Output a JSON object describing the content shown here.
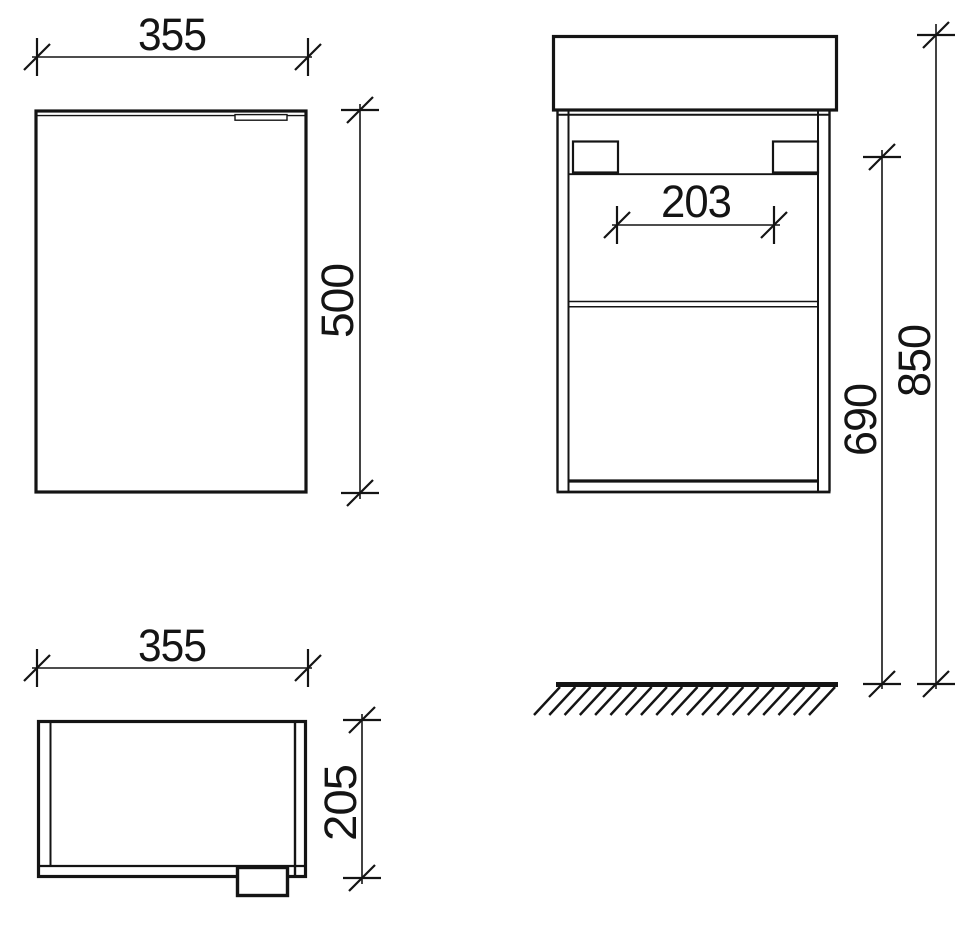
{
  "drawing": {
    "kind": "cabinet-orthographic-dimension-drawing",
    "background_color": "#ffffff",
    "line_color": "#141414",
    "views": {
      "front": {
        "width_label": "355",
        "height_label": "500"
      },
      "plan": {
        "width_label": "355",
        "depth_label": "205"
      },
      "side": {
        "bracket_gap_label": "203",
        "mounting_height_label": "690",
        "overall_height_label": "850"
      }
    }
  }
}
